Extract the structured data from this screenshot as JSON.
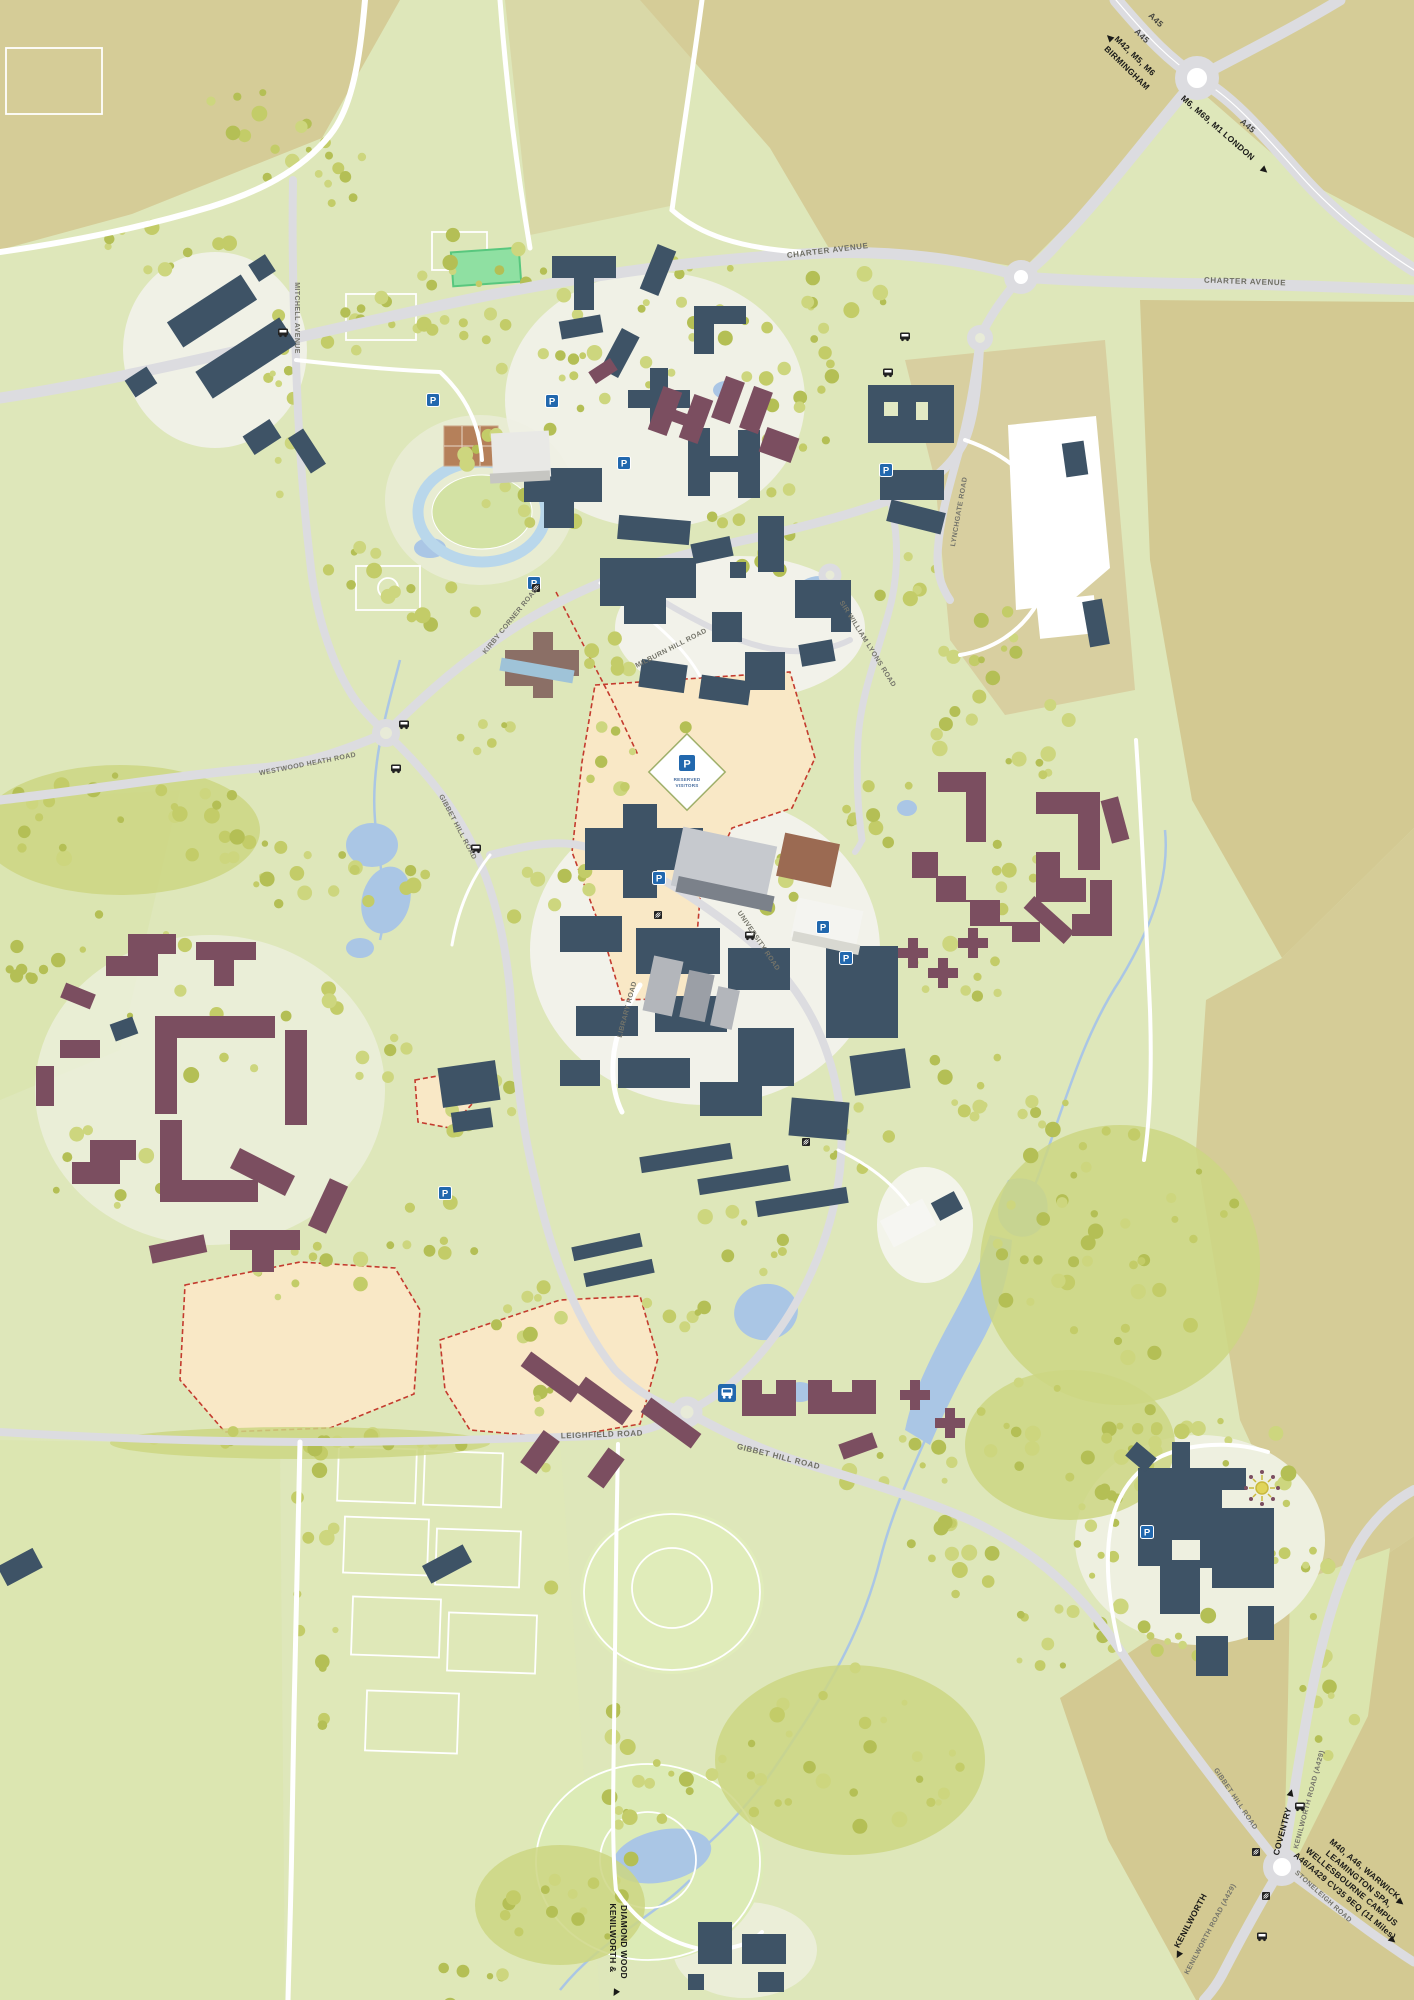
{
  "map": {
    "region": "University campus map",
    "road_labels": {
      "charter_avenue": "CHARTER AVENUE",
      "mitchell_avenue": "MITCHELL AVENUE",
      "westwood_heath_road": "WESTWOOD HEATH ROAD",
      "kirby_corner_road": "KIRBY CORNER ROAD",
      "lynchgate_road": "LYNCHGATE ROAD",
      "milburn_hill_road": "MILBURN HILL ROAD",
      "sir_william_lyons_road": "SIR WILLIAM LYONS ROAD",
      "university_road": "UNIVERSITY ROAD",
      "library_road": "LIBRARY ROAD",
      "gibbet_hill_road": "GIBBET HILL ROAD",
      "leighfield_road": "LEIGHFIELD ROAD",
      "kenilworth_road_a429": "KENILWORTH ROAD (A429)",
      "stoneleigh_road": "STONELEIGH ROAD",
      "a45": "A45"
    },
    "destination_signs": {
      "birmingham_line1": "M42, M5, M6",
      "birmingham_line2": "BIRMINGHAM",
      "london": "M6, M69, M1 LONDON",
      "coventry": "COVENTRY",
      "kenilworth": "KENILWORTH",
      "diamond_wood_line1": "KENILWORTH &",
      "diamond_wood_line2": "DIAMOND WOOD",
      "wellesbourne_line1": "M40, A46, WARWICK,",
      "wellesbourne_line2": "LEAMINGTON SPA,",
      "wellesbourne_line3": "WELLESBOURNE CAMPUS",
      "wellesbourne_line4": "A46/A429 CV35 9EQ (11 Miles)"
    },
    "markers": {
      "parking_letter": "P",
      "reserved_visitors_line1": "RESERVED",
      "reserved_visitors_line2": "VISITORS"
    },
    "palette": {
      "field_tan": "#d5cc97",
      "field_green": "#dee7ba",
      "tree_olive": "#c3cc68",
      "academic_building": "#3e5366",
      "residential_building": "#7b4e60",
      "water": "#aac6e5",
      "road": "#dcdce0",
      "development_zone": "#f9e8c6",
      "parking_blue": "#2268ae"
    }
  }
}
